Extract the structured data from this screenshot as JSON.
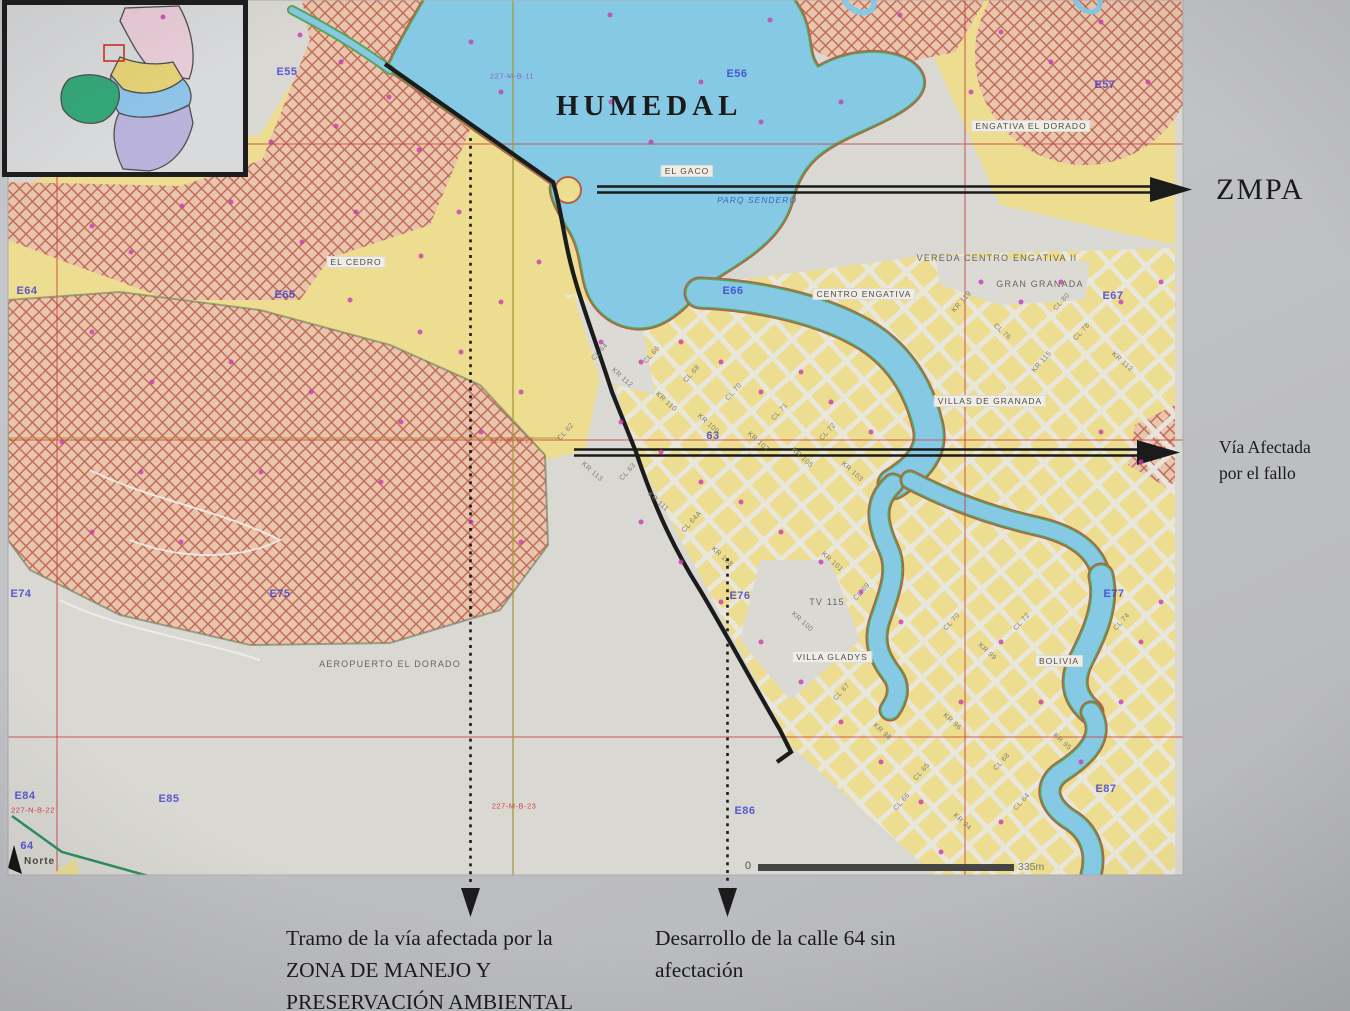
{
  "title_label": "HUMEDAL",
  "arrows": {
    "zmpa": "ZMPA",
    "via_line1": "Vía Afectada",
    "via_line2": "por el fallo"
  },
  "captions": {
    "left": [
      "Tramo de la vía afectada por la",
      "ZONA DE MANEJO Y",
      "PRESERVACIÓN AMBIENTAL"
    ],
    "right": [
      "Desarrollo de la calle 64 sin",
      "afectación"
    ]
  },
  "scale_bar": {
    "start": "0",
    "end": "335m"
  },
  "north_label": "Norte",
  "map_labels": {
    "boxed": [
      {
        "text": "EL GACO",
        "x": 687,
        "y": 171
      },
      {
        "text": "ENGATIVA EL DORADO",
        "x": 1031,
        "y": 126
      },
      {
        "text": "CENTRO ENGATIVA",
        "x": 864,
        "y": 294
      },
      {
        "text": "VILLAS DE GRANADA",
        "x": 990,
        "y": 401
      },
      {
        "text": "EL CEDRO",
        "x": 356,
        "y": 262
      },
      {
        "text": "VILLA GLADYS",
        "x": 832,
        "y": 657
      },
      {
        "text": "BOLIVIA",
        "x": 1059,
        "y": 661
      }
    ],
    "plain": [
      {
        "text": "VEREDA CENTRO ENGATIVA II",
        "x": 997,
        "y": 258
      },
      {
        "text": "GRAN GRANADA",
        "x": 1040,
        "y": 284
      },
      {
        "text": "AEROPUERTO EL DORADO",
        "x": 390,
        "y": 664
      },
      {
        "text": "TV 115",
        "x": 827,
        "y": 602
      },
      {
        "text": "PARQ SENDERO",
        "x": 757,
        "y": 200,
        "cls": "blueit"
      }
    ],
    "grid": [
      {
        "text": "E55",
        "x": 287,
        "y": 72
      },
      {
        "text": "E56",
        "x": 737,
        "y": 74
      },
      {
        "text": "E57",
        "x": 1105,
        "y": 85
      },
      {
        "text": "E64",
        "x": 27,
        "y": 291
      },
      {
        "text": "E65",
        "x": 285,
        "y": 295
      },
      {
        "text": "E66",
        "x": 733,
        "y": 291
      },
      {
        "text": "E67",
        "x": 1113,
        "y": 296
      },
      {
        "text": "E74",
        "x": 21,
        "y": 594
      },
      {
        "text": "E75",
        "x": 280,
        "y": 594
      },
      {
        "text": "E76",
        "x": 740,
        "y": 596
      },
      {
        "text": "E77",
        "x": 1114,
        "y": 594
      },
      {
        "text": "E84",
        "x": 25,
        "y": 796
      },
      {
        "text": "E85",
        "x": 169,
        "y": 799
      },
      {
        "text": "E86",
        "x": 745,
        "y": 811
      },
      {
        "text": "E87",
        "x": 1106,
        "y": 789
      },
      {
        "text": "63",
        "x": 713,
        "y": 436
      },
      {
        "text": "64",
        "x": 27,
        "y": 846
      }
    ],
    "graticule": [
      {
        "text": "227-M-B-11",
        "x": 512,
        "y": 76,
        "color": "#7e6cc8"
      },
      {
        "text": "227-M-B-21",
        "x": 512,
        "y": 440,
        "color": "#cc5533"
      },
      {
        "text": "227-M-B-23",
        "x": 514,
        "y": 806,
        "color": "#cc4444"
      },
      {
        "text": "227-N-B-22",
        "x": 33,
        "y": 810,
        "color": "#cc4444"
      }
    ],
    "streets": [
      {
        "text": "CL 64",
        "x": 600,
        "y": 352,
        "r": -48
      },
      {
        "text": "KR 112",
        "x": 622,
        "y": 378,
        "r": 42
      },
      {
        "text": "CL 66",
        "x": 652,
        "y": 355,
        "r": -48
      },
      {
        "text": "KR 110",
        "x": 666,
        "y": 402,
        "r": 42
      },
      {
        "text": "CL 68",
        "x": 692,
        "y": 374,
        "r": -48
      },
      {
        "text": "KR 109",
        "x": 708,
        "y": 424,
        "r": 42
      },
      {
        "text": "CL 70",
        "x": 734,
        "y": 392,
        "r": -48
      },
      {
        "text": "KR 107",
        "x": 758,
        "y": 442,
        "r": 42
      },
      {
        "text": "CL 71",
        "x": 780,
        "y": 412,
        "r": -48
      },
      {
        "text": "KR 105",
        "x": 802,
        "y": 458,
        "r": 42
      },
      {
        "text": "CL 72",
        "x": 828,
        "y": 432,
        "r": -48
      },
      {
        "text": "KR 103",
        "x": 852,
        "y": 472,
        "r": 42
      },
      {
        "text": "CL 63",
        "x": 628,
        "y": 472,
        "r": -48
      },
      {
        "text": "KR 111",
        "x": 658,
        "y": 502,
        "r": 42
      },
      {
        "text": "CL 64A",
        "x": 692,
        "y": 522,
        "r": -48
      },
      {
        "text": "KR 108",
        "x": 722,
        "y": 557,
        "r": 42
      },
      {
        "text": "CL 62",
        "x": 566,
        "y": 432,
        "r": -48
      },
      {
        "text": "KR 113",
        "x": 592,
        "y": 472,
        "r": 42
      },
      {
        "text": "KR 119",
        "x": 962,
        "y": 302,
        "r": -48
      },
      {
        "text": "CL 76",
        "x": 1002,
        "y": 332,
        "r": 42
      },
      {
        "text": "KR 115",
        "x": 1042,
        "y": 362,
        "r": -48
      },
      {
        "text": "CL 78",
        "x": 1082,
        "y": 332,
        "r": -48
      },
      {
        "text": "KR 113",
        "x": 1122,
        "y": 362,
        "r": 42
      },
      {
        "text": "CL 80",
        "x": 1062,
        "y": 302,
        "r": -48
      },
      {
        "text": "CL 70",
        "x": 952,
        "y": 622,
        "r": -48
      },
      {
        "text": "KR 99",
        "x": 987,
        "y": 652,
        "r": 42
      },
      {
        "text": "CL 72",
        "x": 1022,
        "y": 622,
        "r": -48
      },
      {
        "text": "CL 74",
        "x": 1122,
        "y": 622,
        "r": -48
      },
      {
        "text": "KR 96",
        "x": 952,
        "y": 722,
        "r": 42
      },
      {
        "text": "CL 68",
        "x": 1002,
        "y": 762,
        "r": -48
      },
      {
        "text": "KR 95",
        "x": 1062,
        "y": 742,
        "r": 42
      },
      {
        "text": "CL 66",
        "x": 902,
        "y": 802,
        "r": -48
      },
      {
        "text": "KR 94",
        "x": 962,
        "y": 822,
        "r": 42
      },
      {
        "text": "CL 64",
        "x": 1022,
        "y": 802,
        "r": -48
      },
      {
        "text": "KR 101",
        "x": 832,
        "y": 562,
        "r": 42
      },
      {
        "text": "CL 69",
        "x": 862,
        "y": 592,
        "r": -48
      },
      {
        "text": "KR 100",
        "x": 802,
        "y": 622,
        "r": 42
      },
      {
        "text": "CL 67",
        "x": 842,
        "y": 692,
        "r": -48
      },
      {
        "text": "KR 98",
        "x": 882,
        "y": 732,
        "r": 42
      },
      {
        "text": "CL 65",
        "x": 922,
        "y": 772,
        "r": -48
      }
    ]
  },
  "dots": [
    [
      163,
      17
    ],
    [
      300,
      35
    ],
    [
      341,
      62
    ],
    [
      389,
      97
    ],
    [
      419,
      150
    ],
    [
      336,
      126
    ],
    [
      271,
      142
    ],
    [
      231,
      202
    ],
    [
      182,
      206
    ],
    [
      131,
      252
    ],
    [
      92,
      226
    ],
    [
      356,
      212
    ],
    [
      302,
      242
    ],
    [
      421,
      256
    ],
    [
      459,
      212
    ],
    [
      350,
      300
    ],
    [
      420,
      332
    ],
    [
      501,
      302
    ],
    [
      539,
      262
    ],
    [
      461,
      352
    ],
    [
      92,
      332
    ],
    [
      152,
      382
    ],
    [
      231,
      362
    ],
    [
      311,
      392
    ],
    [
      401,
      422
    ],
    [
      481,
      432
    ],
    [
      521,
      392
    ],
    [
      62,
      442
    ],
    [
      141,
      472
    ],
    [
      261,
      472
    ],
    [
      381,
      482
    ],
    [
      471,
      522
    ],
    [
      521,
      542
    ],
    [
      181,
      542
    ],
    [
      92,
      532
    ],
    [
      601,
      342
    ],
    [
      641,
      362
    ],
    [
      681,
      342
    ],
    [
      721,
      362
    ],
    [
      761,
      392
    ],
    [
      801,
      372
    ],
    [
      831,
      402
    ],
    [
      871,
      432
    ],
    [
      621,
      422
    ],
    [
      661,
      452
    ],
    [
      701,
      482
    ],
    [
      741,
      502
    ],
    [
      781,
      532
    ],
    [
      821,
      562
    ],
    [
      861,
      592
    ],
    [
      901,
      622
    ],
    [
      641,
      522
    ],
    [
      681,
      562
    ],
    [
      721,
      602
    ],
    [
      761,
      642
    ],
    [
      801,
      682
    ],
    [
      841,
      722
    ],
    [
      881,
      762
    ],
    [
      921,
      802
    ],
    [
      961,
      702
    ],
    [
      1001,
      642
    ],
    [
      1041,
      702
    ],
    [
      1081,
      762
    ],
    [
      1001,
      822
    ],
    [
      941,
      852
    ],
    [
      1121,
      702
    ],
    [
      1141,
      642
    ],
    [
      981,
      282
    ],
    [
      1021,
      302
    ],
    [
      1061,
      282
    ],
    [
      1121,
      302
    ],
    [
      1161,
      282
    ],
    [
      1101,
      432
    ],
    [
      1141,
      462
    ],
    [
      1161,
      602
    ],
    [
      1001,
      32
    ],
    [
      1051,
      62
    ],
    [
      1101,
      22
    ],
    [
      1148,
      82
    ],
    [
      971,
      92
    ],
    [
      611,
      102
    ],
    [
      651,
      142
    ],
    [
      701,
      82
    ],
    [
      761,
      122
    ],
    [
      841,
      102
    ],
    [
      471,
      42
    ],
    [
      501,
      92
    ],
    [
      770,
      20
    ],
    [
      900,
      15
    ],
    [
      610,
      15
    ]
  ],
  "colors": {
    "water": "#85c9e5",
    "urban_yellow": "#ecdd90",
    "hatch_fill": "#e9c5ad",
    "hatch_line": "#c06a58",
    "grid_red": "#c94040",
    "label_blue": "#3d3dcf",
    "dot_magenta": "#c93bb1",
    "annotation_black": "#1b1b1b",
    "photo_gray": "#c2c3c7"
  }
}
